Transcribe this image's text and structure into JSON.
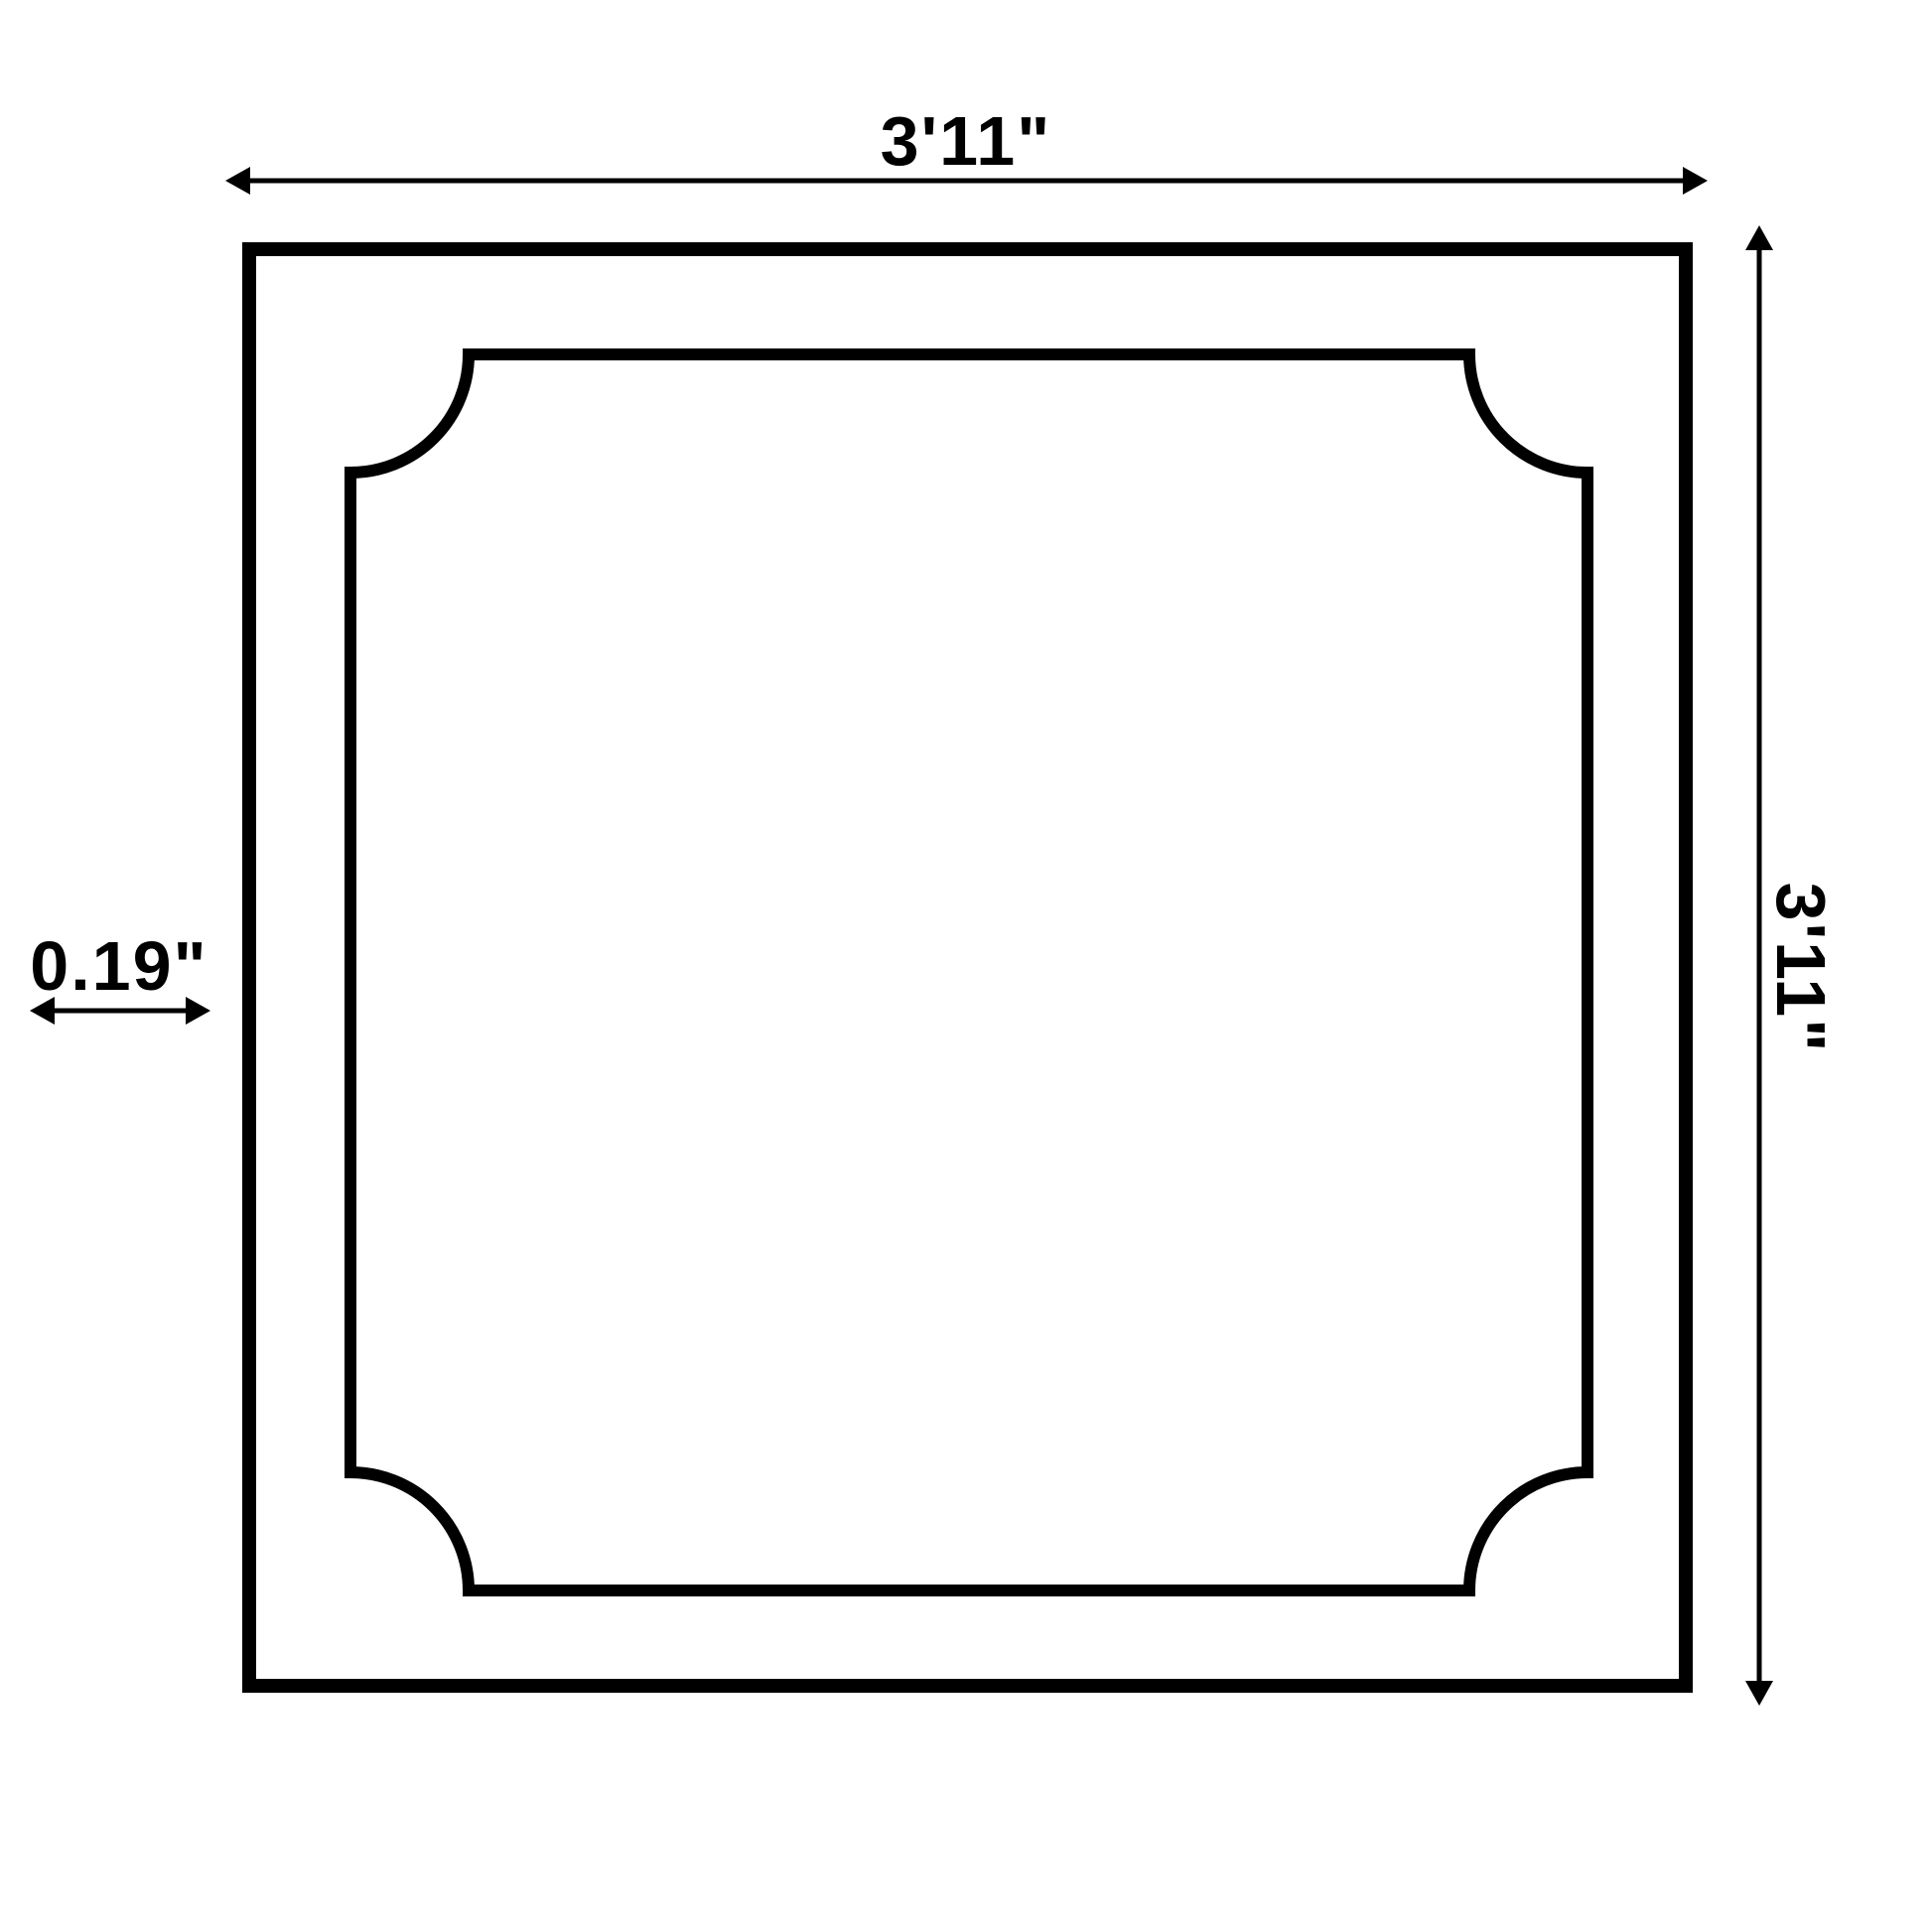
{
  "page": {
    "background_color": "#ffffff",
    "line_color": "#000000"
  },
  "diagram": {
    "type": "dimension-drawing",
    "subject": "square panel with inverted-radius inner molding",
    "dimensions": {
      "width_label": "3'11\"",
      "height_label": "3'11\"",
      "frame_thickness_label": "0.19\""
    }
  }
}
